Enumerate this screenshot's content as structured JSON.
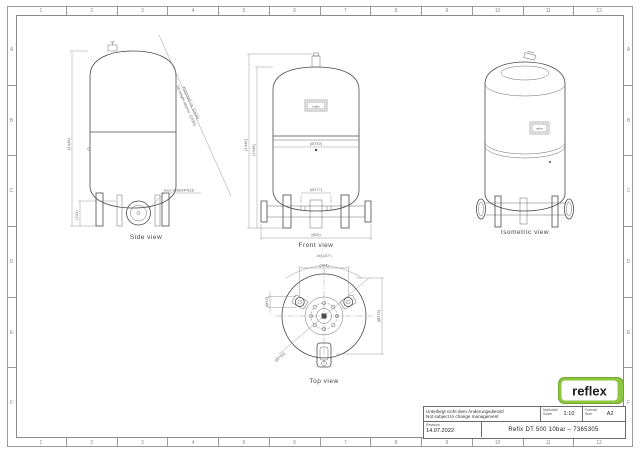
{
  "frame": {
    "columns": [
      "1",
      "2",
      "3",
      "4",
      "5",
      "6",
      "7",
      "8",
      "9",
      "10",
      "11",
      "12"
    ],
    "rows": [
      "A",
      "B",
      "C",
      "D",
      "E",
      "F"
    ]
  },
  "views": {
    "side": {
      "label": "Side view",
      "dims": {
        "height": "[1446]",
        "conn_height": "(215)",
        "tilt_line1": "Kippmaß ca. (1530)",
        "tilt_line2": "Tilt height approx. (1530)",
        "connection": "Duo DN80/PN16"
      }
    },
    "front": {
      "label": "Front view",
      "nameplate": "reflex",
      "dims": {
        "outer_height": "[1446]",
        "inner_height": "(1346)",
        "diameter": "(Ø740)",
        "conn_width": "(Ø177)",
        "base_width": "(600)"
      }
    },
    "isometric": {
      "label": "Isometric view",
      "nameplate": "reflex"
    },
    "top": {
      "label": "Top view",
      "dims": {
        "angle": "3x(120°)",
        "leg_span": "(494)",
        "hole": "(Ø13)",
        "diameter": "(Ø740)",
        "leg_circle": "(Ø575)"
      }
    }
  },
  "titleblock": {
    "change_note_line1": "Unterliegt nicht dem Änderungsdienst/",
    "change_note_line2": "Not subject to change management",
    "scale_label1": "Maßstab/",
    "scale_label2": "Scale",
    "scale_value": "1:10",
    "format_label1": "Format/",
    "format_label2": "Size",
    "format_value": "A2",
    "revision_label": "Revision",
    "revision_value": "14.07.2022",
    "title": "Refix DT 500 10bar  –  7365305",
    "logo_text": "reflex",
    "logo_color": "#8dc63f",
    "logo_border_color": "#74a62f"
  }
}
